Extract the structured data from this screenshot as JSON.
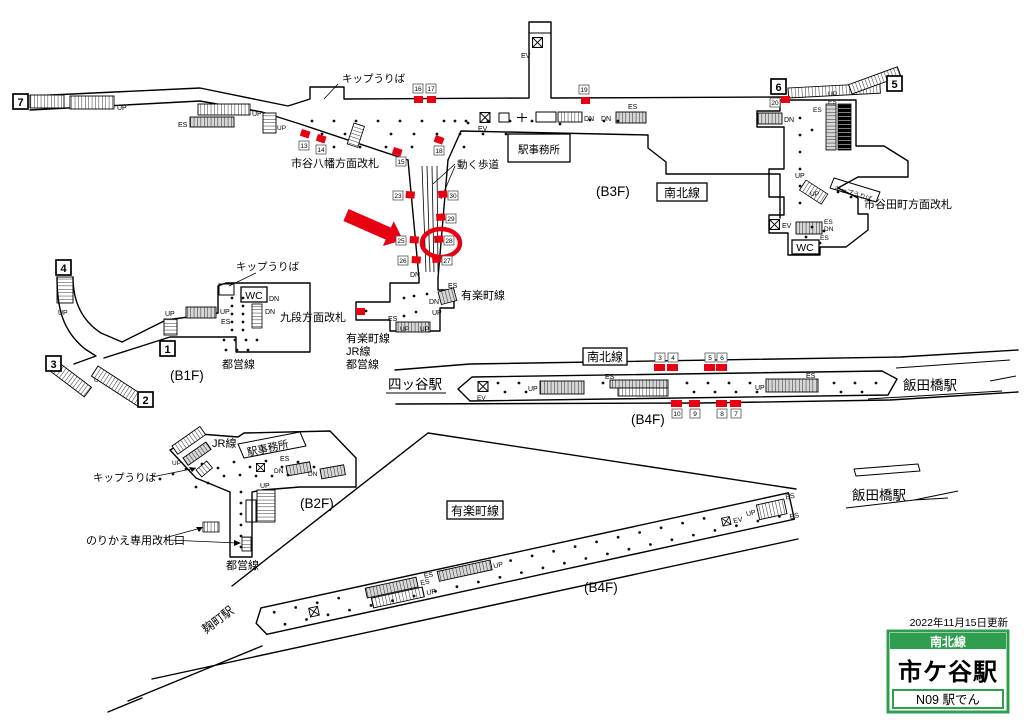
{
  "strings": {
    "up": "UP",
    "dn": "DN",
    "es": "ES",
    "ev": "EV",
    "wc": "WC"
  },
  "labels": {
    "kippu_top": "キップうりば",
    "hachiman_gate": "市谷八幡方面改札",
    "ugoku_hodo": "動く歩道",
    "ekijimusho_b3f": "駅事務所",
    "floor_b3f": "(B3F)",
    "namboku_b3f": "南北線",
    "tamachi_gate": "市谷田町方面改札",
    "kippu_tamachi": "キップうりば",
    "kippu_b1f": "キップうりば",
    "kudan_gate": "九段方面改札",
    "toei_b1f": "都営線",
    "floor_b1f": "(B1F)",
    "yurakucho_near_corridor": "有楽町線",
    "transfer_line1": "有楽町線",
    "transfer_line2": "JR線",
    "transfer_line3": "都営線",
    "namboku_platform": "南北線",
    "floor_b4f_namboku": "(B4F)",
    "yotsuya": "四ッ谷駅",
    "iidabashi_namboku": "飯田橋駅",
    "iidabashi_yurakucho": "飯田橋駅",
    "jr_b2f": "JR線",
    "ekijimusho_b2f": "駅事務所",
    "kippu_b2f": "キップうりば",
    "norikae_gate": "のりかえ専用改札口",
    "toei_b2f": "都営線",
    "floor_b2f": "(B2F)",
    "yurakucho_platform": "有楽町線",
    "floor_b4f_yurakucho": "(B4F)",
    "kojimachi": "麹町駅"
  },
  "legend": {
    "updated": "2022年11月15日更新",
    "line": "南北線",
    "station": "市ケ谷駅",
    "code": "N09 駅でん"
  },
  "colors": {
    "red": "#e60012",
    "green": "#2f9e4e"
  },
  "map": {
    "exits": [
      {
        "n": "7",
        "x": 13,
        "y": 94
      },
      {
        "n": "6",
        "x": 771,
        "y": 79
      },
      {
        "n": "5",
        "x": 887,
        "y": 76
      },
      {
        "n": "4",
        "x": 56,
        "y": 260
      },
      {
        "n": "3",
        "x": 46,
        "y": 356
      },
      {
        "n": "2",
        "x": 138,
        "y": 392
      },
      {
        "n": "1",
        "x": 160,
        "y": 341
      }
    ],
    "badges": [
      {
        "n": "13",
        "x": 299,
        "y": 141
      },
      {
        "n": "14",
        "x": 316,
        "y": 145
      },
      {
        "n": "15",
        "x": 396,
        "y": 157
      },
      {
        "n": "16",
        "x": 413,
        "y": 84
      },
      {
        "n": "17",
        "x": 426,
        "y": 84
      },
      {
        "n": "18",
        "x": 434,
        "y": 146
      },
      {
        "n": "19",
        "x": 579,
        "y": 85
      },
      {
        "n": "20",
        "x": 770,
        "y": 98
      },
      {
        "n": "23",
        "x": 393,
        "y": 191
      },
      {
        "n": "25",
        "x": 396,
        "y": 236
      },
      {
        "n": "26",
        "x": 398,
        "y": 256
      },
      {
        "n": "30",
        "x": 448,
        "y": 191
      },
      {
        "n": "29",
        "x": 446,
        "y": 214
      },
      {
        "n": "28",
        "x": 444,
        "y": 236
      },
      {
        "n": "27",
        "x": 442,
        "y": 256
      },
      {
        "n": "3",
        "x": 655,
        "y": 353
      },
      {
        "n": "4",
        "x": 668,
        "y": 353
      },
      {
        "n": "5",
        "x": 705,
        "y": 353
      },
      {
        "n": "6",
        "x": 717,
        "y": 353
      },
      {
        "n": "10",
        "x": 672,
        "y": 409
      },
      {
        "n": "9",
        "x": 690,
        "y": 409
      },
      {
        "n": "8",
        "x": 717,
        "y": 409
      },
      {
        "n": "7",
        "x": 731,
        "y": 409
      }
    ],
    "red_squares": [
      {
        "x": 302,
        "y": 129,
        "r": 18
      },
      {
        "x": 318,
        "y": 134,
        "r": 18
      },
      {
        "x": 394,
        "y": 147,
        "r": 18
      },
      {
        "x": 436,
        "y": 135,
        "r": 20
      },
      {
        "x": 414,
        "y": 96
      },
      {
        "x": 427,
        "y": 96
      },
      {
        "x": 581,
        "y": 97
      },
      {
        "x": 781,
        "y": 96
      },
      {
        "x": 406,
        "y": 191,
        "r": 4
      },
      {
        "x": 410,
        "y": 236,
        "r": 4
      },
      {
        "x": 412,
        "y": 256,
        "r": 4
      },
      {
        "x": 438,
        "y": 191,
        "r": -4
      },
      {
        "x": 436,
        "y": 214,
        "r": -4
      },
      {
        "x": 434,
        "y": 236,
        "r": -4
      },
      {
        "x": 432,
        "y": 256,
        "r": -4
      },
      {
        "x": 356,
        "y": 308
      },
      {
        "x": 654,
        "y": 364,
        "w": 11
      },
      {
        "x": 667,
        "y": 364,
        "w": 11
      },
      {
        "x": 704,
        "y": 364,
        "w": 11
      },
      {
        "x": 716,
        "y": 364,
        "w": 11
      },
      {
        "x": 671,
        "y": 400,
        "w": 11
      },
      {
        "x": 689,
        "y": 400,
        "w": 11
      },
      {
        "x": 716,
        "y": 400,
        "w": 11
      },
      {
        "x": 730,
        "y": 400,
        "w": 11
      }
    ]
  }
}
